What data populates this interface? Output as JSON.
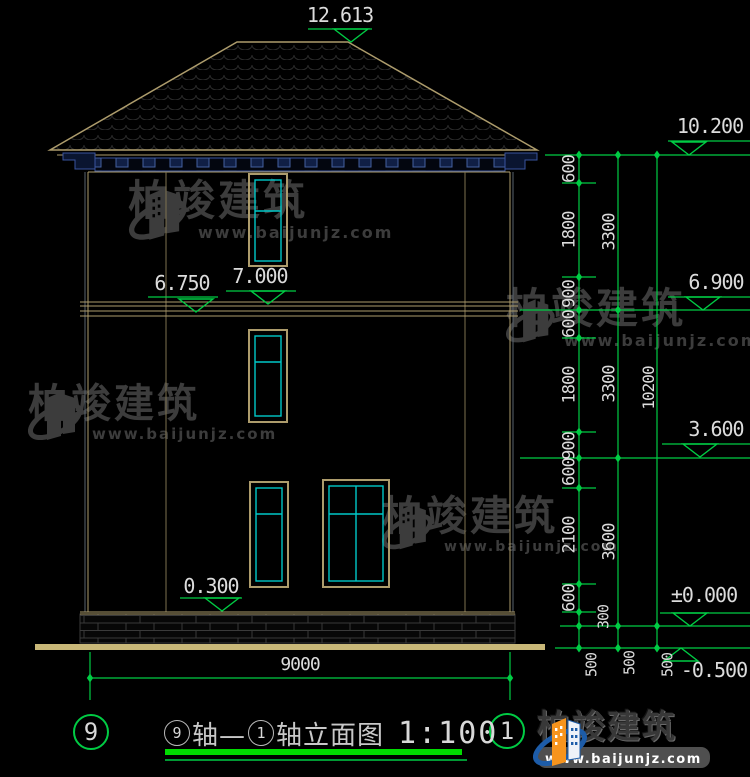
{
  "title_block": {
    "axis_left_bubble": "9",
    "axis_right_bubble": "1",
    "axis_start": "9",
    "connector": "轴—",
    "axis_end": "1",
    "suffix": "轴立面图",
    "scale": "1:100"
  },
  "watermark": {
    "brand": "柏竣建筑",
    "url": "www.baijunjz.com"
  },
  "logo": {
    "brand": "柏竣建筑",
    "url": "www.baijunjz.com"
  },
  "colors": {
    "background": "#000000",
    "dimension_green": "#00cc44",
    "underline_green": "#00dc00",
    "outline_tan": "#ad9c6c",
    "ground_tan": "#c9b878",
    "window_cyan": "#00c8c8",
    "text_white": "#dcdcdc",
    "watermark_gray": "#3c3c3c",
    "bracket_blue": "#39539e",
    "logo_blue": "#1d5ca8",
    "logo_orange": "#f7941d"
  },
  "annotations": [
    {
      "name": "elev-12-613",
      "text": "12.613",
      "x": 340,
      "y": 15,
      "fs": 20
    },
    {
      "name": "elev-10-200",
      "text": "10.200",
      "x": 710,
      "y": 126,
      "fs": 20
    },
    {
      "name": "elev-6-900",
      "text": "6.900",
      "x": 716,
      "y": 282,
      "fs": 20
    },
    {
      "name": "elev-3-600",
      "text": "3.600",
      "x": 716,
      "y": 429,
      "fs": 20
    },
    {
      "name": "elev-plus-0-000",
      "text": "±0.000",
      "x": 704,
      "y": 595,
      "fs": 20
    },
    {
      "name": "elev-minus-0-500",
      "text": "-0.500",
      "x": 714,
      "y": 670,
      "fs": 20
    },
    {
      "name": "elev-7-000",
      "text": "7.000",
      "x": 260,
      "y": 276,
      "fs": 20
    },
    {
      "name": "elev-6-750",
      "text": "6.750",
      "x": 182,
      "y": 283,
      "fs": 20
    },
    {
      "name": "elev-0-300",
      "text": "0.300",
      "x": 211,
      "y": 586,
      "fs": 20
    },
    {
      "name": "dim-total-width",
      "text": "9000",
      "x": 300,
      "y": 665,
      "fs": 18
    },
    {
      "name": "dim-c1-600a",
      "text": "600",
      "x": 570,
      "y": 169,
      "rot": true
    },
    {
      "name": "dim-c1-1800a",
      "text": "1800",
      "x": 570,
      "y": 230,
      "rot": true
    },
    {
      "name": "dim-c1-900a",
      "text": "900",
      "x": 570,
      "y": 294,
      "rot": true
    },
    {
      "name": "dim-c1-600b",
      "text": "600",
      "x": 570,
      "y": 324,
      "rot": true
    },
    {
      "name": "dim-c1-1800b",
      "text": "1800",
      "x": 570,
      "y": 385,
      "rot": true
    },
    {
      "name": "dim-c1-900b",
      "text": "900",
      "x": 570,
      "y": 446,
      "rot": true
    },
    {
      "name": "dim-c1-600c",
      "text": "600",
      "x": 570,
      "y": 472,
      "rot": true
    },
    {
      "name": "dim-c1-2100",
      "text": "2100",
      "x": 570,
      "y": 535,
      "rot": true
    },
    {
      "name": "dim-c1-600d",
      "text": "600",
      "x": 570,
      "y": 598,
      "rot": true
    },
    {
      "name": "dim-c1-300",
      "text": "300",
      "x": 604,
      "y": 617,
      "rot": true,
      "fs": 15
    },
    {
      "name": "dim-c1-500",
      "text": "500",
      "x": 592,
      "y": 665,
      "rot": true,
      "fs": 15
    },
    {
      "name": "dim-c2-3300a",
      "text": "3300",
      "x": 610,
      "y": 232,
      "rot": true
    },
    {
      "name": "dim-c2-3300b",
      "text": "3300",
      "x": 610,
      "y": 384,
      "rot": true
    },
    {
      "name": "dim-c2-3600",
      "text": "3600",
      "x": 610,
      "y": 542,
      "rot": true
    },
    {
      "name": "dim-c2-500",
      "text": "500",
      "x": 630,
      "y": 663,
      "rot": true,
      "fs": 15
    },
    {
      "name": "dim-c3-10200",
      "text": "10200",
      "x": 649,
      "y": 388,
      "rot": true,
      "fs": 16
    },
    {
      "name": "dim-c3-500",
      "text": "500",
      "x": 668,
      "y": 665,
      "rot": true,
      "fs": 15
    }
  ]
}
